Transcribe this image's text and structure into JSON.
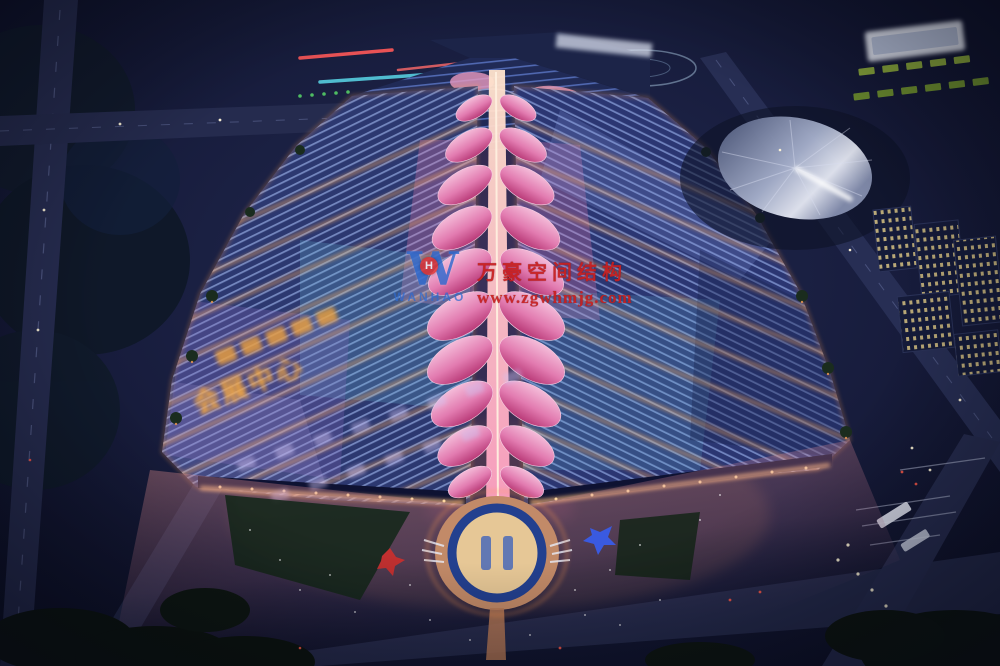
{
  "scene": {
    "title": "Aerial night rendering of a large exhibition and convention center",
    "roof_sign_text": "会展中心",
    "palette": {
      "sky": "#11142c",
      "roof_blue": "#2c3870",
      "roof_stripe": "#93a8e0",
      "petal_pink": "#d9639e",
      "walkway_warm": "#ffd9b8",
      "accent_orange": "#f0a050",
      "plaza_warm": "#e8967e",
      "road": "#262c50",
      "tree_dark": "#101c16",
      "cone_tent": "#c7cfe4",
      "window_light": "#d8c382"
    }
  },
  "watermark": {
    "company_cn": "万豪空间结构",
    "website": "www.zgwhmjg.com",
    "logo_letter": "W",
    "logo_badge": "H",
    "logo_caption": "WANHAO",
    "text_color": "#c81e1e",
    "logo_color": "#2f6bd0",
    "badge_color": "#e03030"
  }
}
